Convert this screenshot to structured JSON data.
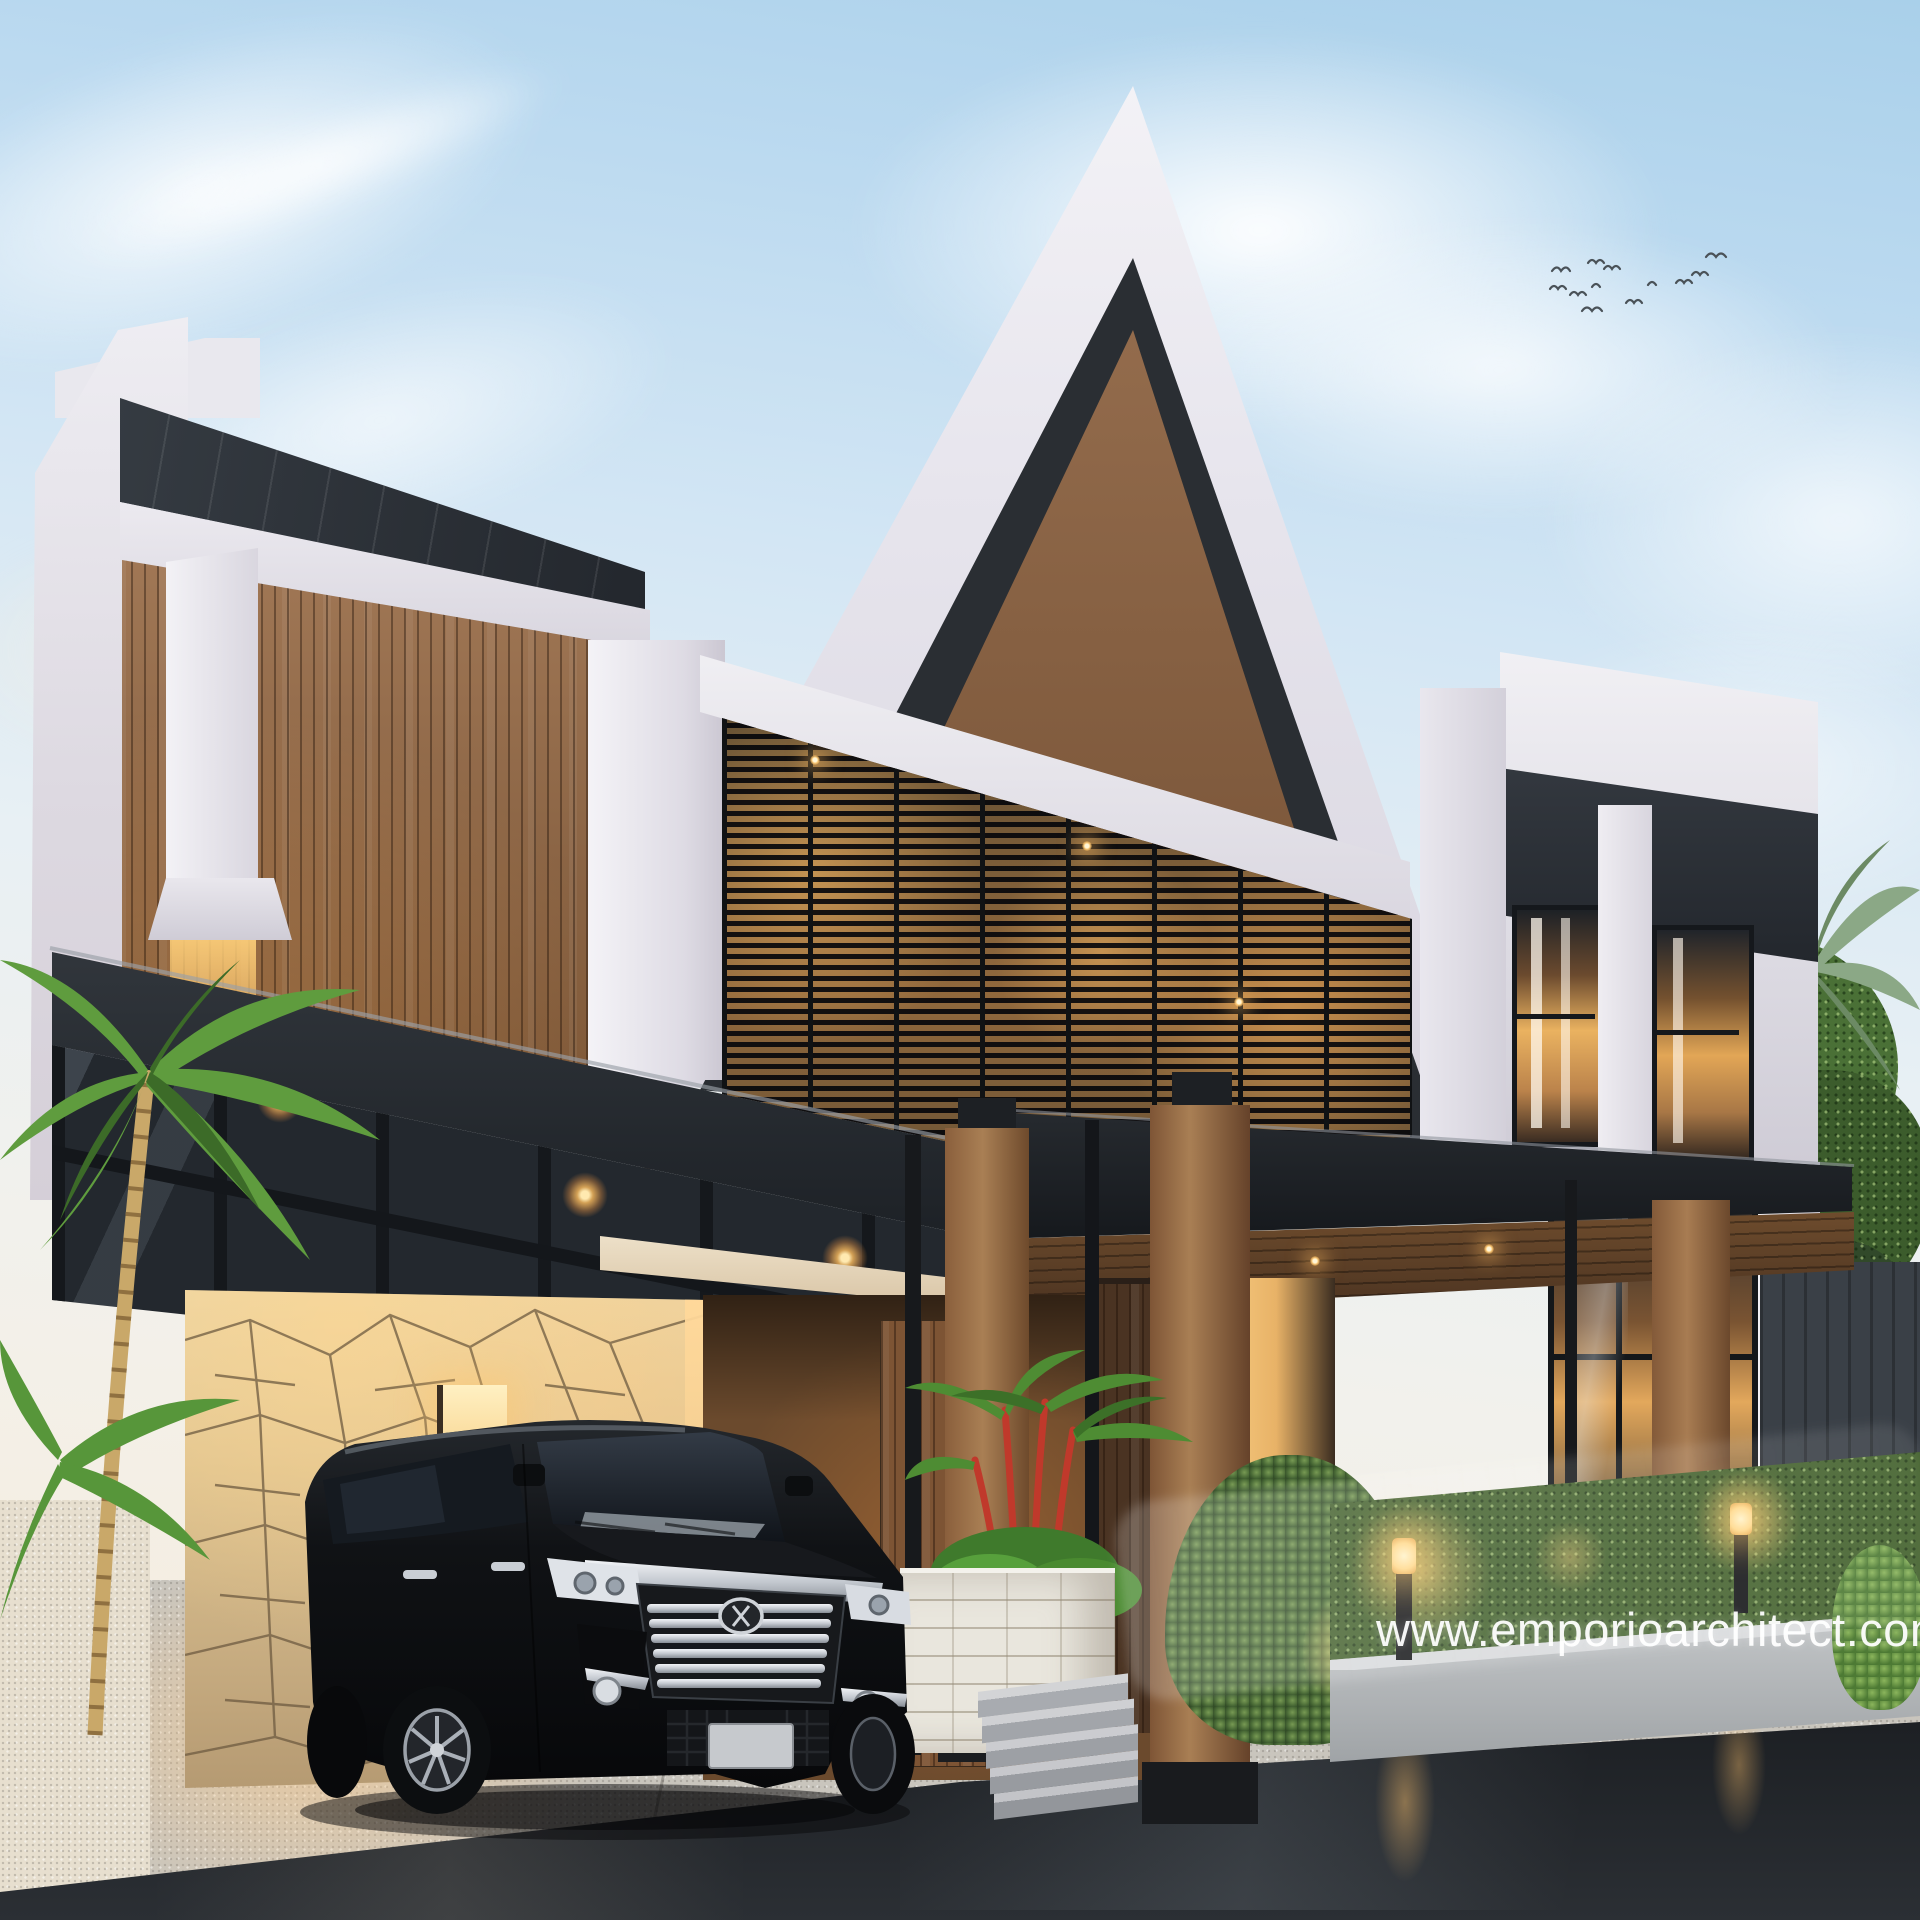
{
  "title": "Architectural 3D exterior rendering of a modern tropical gable house at dusk",
  "watermark": {
    "text": "www.emporioarchitect.com",
    "color": "#ffffff"
  },
  "environment": {
    "time_of_day": "dusk",
    "sky_top_color": "#a9d0ea",
    "sky_horizon_color": "#f7f0e4",
    "birds_count": 12,
    "ground": "wet asphalt road with light reflections"
  },
  "building": {
    "style": "modern gable / scandinavian tropical",
    "storeys": 2,
    "gable_cladding_color": "#8a5f3d",
    "wall_color": "#eceaf1",
    "accent_dark_color": "#26292e",
    "metal_roof_color": "#2e343a",
    "stone_wall_color": "#dfc491",
    "interior_light_color": "#f2b969",
    "features": [
      "large white-framed gable with vertical wood slats",
      "full-width black steel canopy and pergola carport",
      "horizontal louvered second-floor facade with warm interior light",
      "crazy-paving stone feature wall at carport",
      "timber porch pillars with black steel bases",
      "white brick planter with red-stem lipstick palm",
      "granite entrance steps",
      "trimmed hedge in concrete planter with bollard lights"
    ]
  },
  "vehicle": {
    "type": "black luxury minivan",
    "color": "#0c0e10",
    "details": [
      "large chrome multi-bar grille",
      "chrome fog lamp blades",
      "silver alloy wheels",
      "blank grey license plate"
    ]
  },
  "vegetation": [
    "left foreground palm tree",
    "right background palm tree",
    "tropical tree mass right",
    "conical shrub",
    "round shrub",
    "long trimmed hedge",
    "red-stem lipstick palm at entrance"
  ],
  "lighting": {
    "bollard_lights": 2,
    "canopy_downlights": 3,
    "soffit_downlights": 2,
    "facade_sparkle_lights": 3,
    "light_color": "#ffd98c"
  },
  "palette": {
    "warm_glow": "#f2b969",
    "canopy_black": "#23272c",
    "driveway": "#c9c5bd",
    "asphalt": "#17191d",
    "hedge_green": "#44622e",
    "palm_green": "#5f9c3e"
  }
}
